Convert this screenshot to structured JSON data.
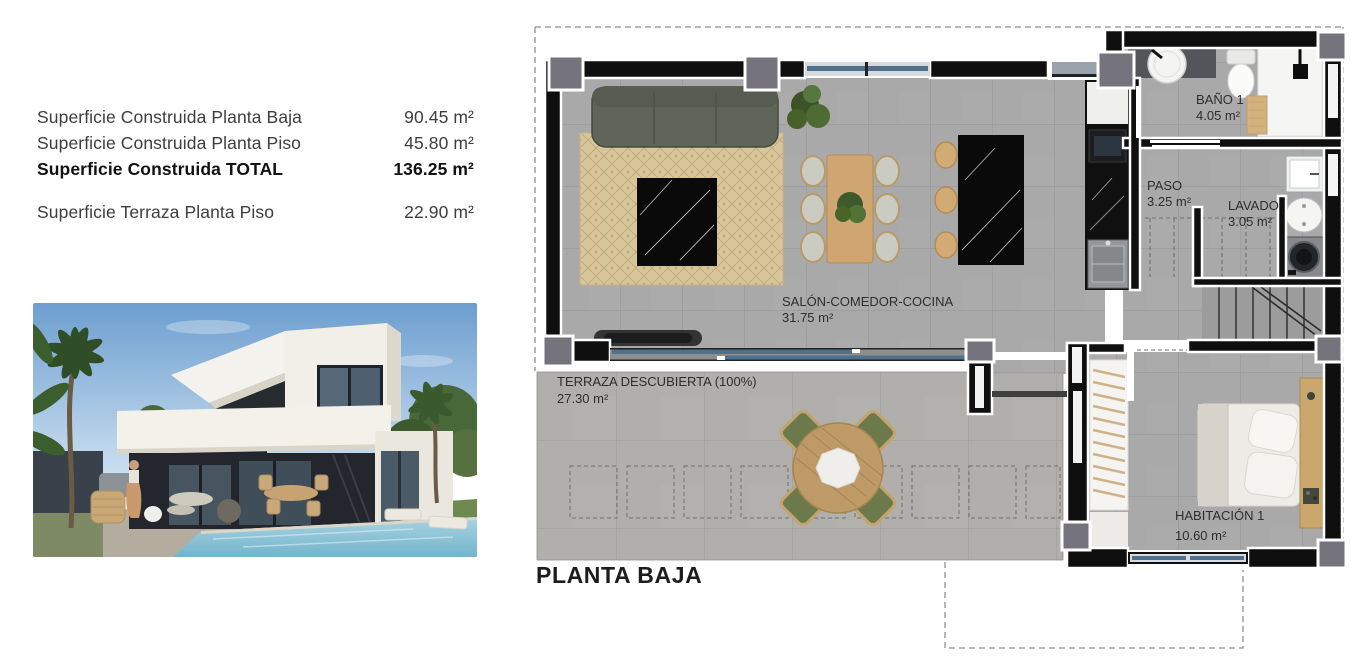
{
  "summary": {
    "rows": [
      {
        "label": "Superficie Construida Planta Baja",
        "value": "90.45 m²"
      },
      {
        "label": "Superficie Construida Planta Piso",
        "value": "45.80 m²"
      },
      {
        "label": "Superficie Construida TOTAL",
        "value": "136.25 m²"
      },
      {
        "label": "Superficie Terraza Planta Piso",
        "value": "22.90 m²"
      }
    ]
  },
  "floorplan": {
    "title": "PLANTA BAJA",
    "rooms": [
      {
        "name": "SALÓN-COMEDOR-COCINA",
        "area": "31.75 m²"
      },
      {
        "name": "TERRAZA DESCUBIERTA (100%)",
        "area": "27.30 m²"
      },
      {
        "name": "BAÑO 1",
        "area": "4.05 m²"
      },
      {
        "name": "PASO",
        "area": "3.25 m²"
      },
      {
        "name": "LAVADO",
        "area": "3.05 m²"
      },
      {
        "name": "HABITACIÓN 1",
        "area": "10.60 m²"
      }
    ]
  },
  "colors": {
    "wall_black": "#0f0f0f",
    "floor_gray": "#a9a9a9",
    "terrace_gray": "#b1afab",
    "column_gray": "#75737b",
    "glass_blue": "#51708c",
    "rug_beige": "#d9c79c",
    "wood_tan": "#cfa671",
    "terrace_chair_green": "#6c7a4b",
    "label_text": "#2e2e2e"
  }
}
